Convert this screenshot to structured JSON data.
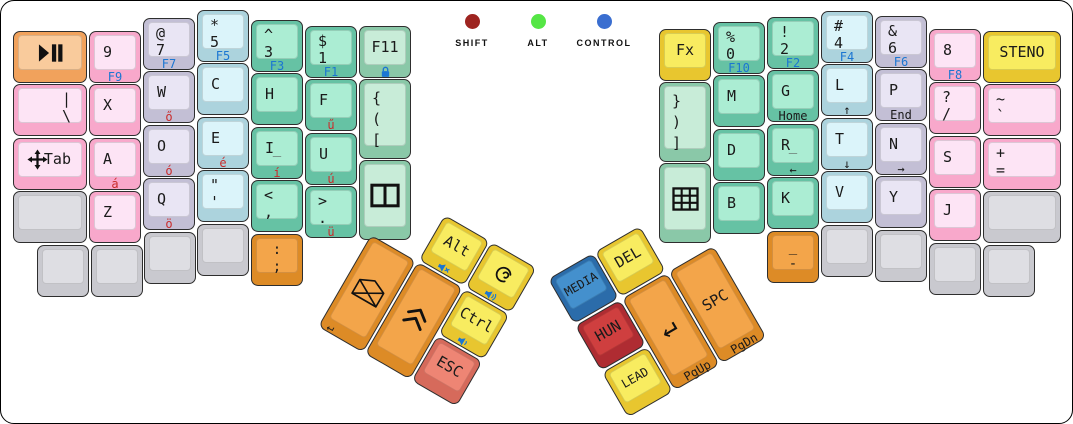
{
  "canvas": {
    "w": 1073,
    "h": 424,
    "bg": "#ffffff",
    "border": "#000000"
  },
  "palette": {
    "pink": {
      "side": "#F8A8CB",
      "top": "#FDE4F5"
    },
    "purple": {
      "side": "#C3BFD5",
      "top": "#E9E5F4"
    },
    "cyan": {
      "side": "#ACD3DD",
      "top": "#DBF4FA"
    },
    "teal": {
      "side": "#66C2A4",
      "top": "#ABEDD3"
    },
    "green": {
      "side": "#8AC8A8",
      "top": "#C8ECD8"
    },
    "yellow": {
      "side": "#E8C62F",
      "top": "#F8EC60"
    },
    "orange": {
      "side": "#DD8B26",
      "top": "#F3A54A"
    },
    "peach": {
      "side": "#F1A25C",
      "top": "#F9CB9C"
    },
    "salmon": {
      "side": "#D66A5B",
      "top": "#EE8574"
    },
    "blue": {
      "side": "#2B6CAA",
      "top": "#4490CD"
    },
    "darkred": {
      "side": "#AF2C32",
      "top": "#CF3F3F"
    },
    "gray": {
      "side": "#C9C9CF",
      "top": "#DEDEE3"
    }
  },
  "legend_colors": {
    "dark": "#1a1a1a",
    "blue": "#1B76D2",
    "red": "#C92B2B",
    "gray": "#555555"
  },
  "indicators": [
    {
      "name": "indicator-shift",
      "label": "SHIFT",
      "color": "#9E2420",
      "cx": 471,
      "top": 13
    },
    {
      "name": "indicator-alt",
      "label": "ALT",
      "color": "#55E645",
      "cx": 537,
      "top": 13
    },
    {
      "name": "indicator-control",
      "label": "CONTROL",
      "color": "#3A6ED0",
      "cx": 603,
      "top": 13
    }
  ],
  "main_keys": [
    {
      "n": "key-play-pause",
      "x": 12,
      "y": 30,
      "w": 74,
      "c": "peach",
      "ic": "play-pause"
    },
    {
      "n": "key-pipe-backslash",
      "x": 12,
      "y": 83,
      "w": 74,
      "c": "pink",
      "t": [
        "|",
        "\\"
      ],
      "a": "r"
    },
    {
      "n": "key-tab",
      "x": 12,
      "y": 137,
      "w": 74,
      "c": "pink",
      "t": [
        "Tab"
      ],
      "a": "sr",
      "ic": "move",
      "icpos": "left"
    },
    {
      "n": "key-blank",
      "x": 12,
      "y": 190,
      "w": 74,
      "c": "gray"
    },
    {
      "n": "key-9",
      "x": 88,
      "y": 30,
      "c": "pink",
      "t": [
        "9"
      ],
      "f": "F9",
      "fc": "blue"
    },
    {
      "n": "key-x",
      "x": 88,
      "y": 83,
      "c": "pink",
      "t": [
        "X"
      ]
    },
    {
      "n": "key-a",
      "x": 88,
      "y": 137,
      "c": "pink",
      "t": [
        "A"
      ],
      "f": "á",
      "fc": "red"
    },
    {
      "n": "key-z",
      "x": 88,
      "y": 190,
      "c": "pink",
      "t": [
        "Z"
      ]
    },
    {
      "n": "key-at-7",
      "x": 142,
      "y": 17,
      "c": "purple",
      "t": [
        "@",
        "7"
      ],
      "f": "F7",
      "fc": "blue"
    },
    {
      "n": "key-w",
      "x": 142,
      "y": 70,
      "c": "purple",
      "t": [
        "W"
      ],
      "f": "ő",
      "fc": "red"
    },
    {
      "n": "key-o",
      "x": 142,
      "y": 124,
      "c": "purple",
      "t": [
        "O"
      ],
      "f": "ó",
      "fc": "red"
    },
    {
      "n": "key-q",
      "x": 142,
      "y": 177,
      "c": "purple",
      "t": [
        "Q"
      ],
      "f": "ö",
      "fc": "red"
    },
    {
      "n": "key-star-5",
      "x": 196,
      "y": 9,
      "c": "cyan",
      "t": [
        "*",
        "5"
      ],
      "f": "F5",
      "fc": "blue"
    },
    {
      "n": "key-c",
      "x": 196,
      "y": 62,
      "c": "cyan",
      "t": [
        "C"
      ]
    },
    {
      "n": "key-e",
      "x": 196,
      "y": 116,
      "c": "cyan",
      "t": [
        "E"
      ],
      "f": "é",
      "fc": "red"
    },
    {
      "n": "key-quote-apostrophe",
      "x": 196,
      "y": 169,
      "c": "cyan",
      "t": [
        "\"",
        "'"
      ]
    },
    {
      "n": "key-caret-3",
      "x": 250,
      "y": 19,
      "c": "teal",
      "t": [
        "^",
        "3"
      ],
      "f": "F3",
      "fc": "blue"
    },
    {
      "n": "key-h",
      "x": 250,
      "y": 72,
      "c": "teal",
      "t": [
        "H"
      ]
    },
    {
      "n": "key-i",
      "x": 250,
      "y": 126,
      "c": "teal",
      "t": [
        "I"
      ],
      "cen": "_",
      "f": "í",
      "fc": "red"
    },
    {
      "n": "key-less-comma",
      "x": 250,
      "y": 179,
      "c": "teal",
      "t": [
        "<",
        ","
      ]
    },
    {
      "n": "key-dollar-1",
      "x": 304,
      "y": 25,
      "c": "teal",
      "t": [
        "$",
        "1"
      ],
      "f": "F1",
      "fc": "blue"
    },
    {
      "n": "key-f",
      "x": 304,
      "y": 78,
      "c": "teal",
      "t": [
        "F"
      ],
      "f": "ű",
      "fc": "red"
    },
    {
      "n": "key-u",
      "x": 304,
      "y": 132,
      "c": "teal",
      "t": [
        "U"
      ],
      "f": "ú",
      "fc": "red"
    },
    {
      "n": "key-greater-period",
      "x": 304,
      "y": 185,
      "c": "teal",
      "t": [
        ">",
        "."
      ],
      "f": "ü",
      "fc": "red"
    },
    {
      "n": "key-f11",
      "x": 358,
      "y": 25,
      "c": "green",
      "t": [
        "F11"
      ],
      "a": "c",
      "fic": "lock"
    },
    {
      "n": "key-open-brackets",
      "x": 358,
      "y": 78,
      "h": 80,
      "c": "green",
      "t": [
        "{",
        "(",
        "["
      ]
    },
    {
      "n": "key-vertical-split",
      "x": 358,
      "y": 159,
      "h": 80,
      "c": "green",
      "ic": "vsplit"
    },
    {
      "n": "key-blank",
      "x": 36,
      "y": 244,
      "c": "gray"
    },
    {
      "n": "key-blank",
      "x": 90,
      "y": 244,
      "c": "gray"
    },
    {
      "n": "key-blank",
      "x": 143,
      "y": 231,
      "c": "gray"
    },
    {
      "n": "key-blank",
      "x": 196,
      "y": 223,
      "c": "gray"
    },
    {
      "n": "key-colon-semicolon",
      "x": 250,
      "y": 233,
      "c": "orange",
      "t": [
        ":",
        ";"
      ],
      "a": "cp"
    },
    {
      "n": "key-fx",
      "x": 658,
      "y": 28,
      "c": "yellow",
      "t": [
        "Fx"
      ],
      "a": "c"
    },
    {
      "n": "key-close-brackets",
      "x": 658,
      "y": 81,
      "h": 80,
      "c": "green",
      "t": [
        "}",
        ")",
        "]"
      ]
    },
    {
      "n": "key-grid",
      "x": 658,
      "y": 162,
      "h": 80,
      "c": "green",
      "ic": "grid"
    },
    {
      "n": "key-percent-0",
      "x": 712,
      "y": 21,
      "c": "teal",
      "t": [
        "%",
        "0"
      ],
      "f": "F10",
      "fc": "blue"
    },
    {
      "n": "key-m",
      "x": 712,
      "y": 74,
      "c": "teal",
      "t": [
        "M"
      ]
    },
    {
      "n": "key-d",
      "x": 712,
      "y": 128,
      "c": "teal",
      "t": [
        "D"
      ]
    },
    {
      "n": "key-b",
      "x": 712,
      "y": 181,
      "c": "teal",
      "t": [
        "B"
      ]
    },
    {
      "n": "key-exclam-2",
      "x": 766,
      "y": 16,
      "c": "teal",
      "t": [
        "!",
        "2"
      ],
      "f": "F2",
      "fc": "blue"
    },
    {
      "n": "key-g",
      "x": 766,
      "y": 69,
      "c": "teal",
      "t": [
        "G"
      ],
      "f": "Home",
      "fc": "dark"
    },
    {
      "n": "key-r",
      "x": 766,
      "y": 123,
      "c": "teal",
      "t": [
        "R"
      ],
      "cen": "_",
      "f": "←",
      "fc": "dark"
    },
    {
      "n": "key-k",
      "x": 766,
      "y": 176,
      "c": "teal",
      "t": [
        "K"
      ]
    },
    {
      "n": "key-hash-4",
      "x": 820,
      "y": 10,
      "c": "cyan",
      "t": [
        "#",
        "4"
      ],
      "f": "F4",
      "fc": "blue"
    },
    {
      "n": "key-l",
      "x": 820,
      "y": 63,
      "c": "cyan",
      "t": [
        "L"
      ],
      "f": "↑",
      "fc": "dark"
    },
    {
      "n": "key-t",
      "x": 820,
      "y": 117,
      "c": "cyan",
      "t": [
        "T"
      ],
      "f": "↓",
      "fc": "dark"
    },
    {
      "n": "key-v",
      "x": 820,
      "y": 170,
      "c": "cyan",
      "t": [
        "V"
      ]
    },
    {
      "n": "key-amp-6",
      "x": 874,
      "y": 15,
      "c": "purple",
      "t": [
        "&",
        "6"
      ],
      "f": "F6",
      "fc": "blue"
    },
    {
      "n": "key-p",
      "x": 874,
      "y": 68,
      "c": "purple",
      "t": [
        "P"
      ],
      "f": "End",
      "fc": "dark"
    },
    {
      "n": "key-n",
      "x": 874,
      "y": 122,
      "c": "purple",
      "t": [
        "N"
      ],
      "f": "→",
      "fc": "dark"
    },
    {
      "n": "key-y",
      "x": 874,
      "y": 175,
      "c": "purple",
      "t": [
        "Y"
      ]
    },
    {
      "n": "key-8",
      "x": 928,
      "y": 28,
      "c": "pink",
      "t": [
        "8"
      ],
      "f": "F8",
      "fc": "blue"
    },
    {
      "n": "key-question-slash",
      "x": 928,
      "y": 81,
      "c": "pink",
      "t": [
        "?",
        "/"
      ]
    },
    {
      "n": "key-s",
      "x": 928,
      "y": 135,
      "c": "pink",
      "t": [
        "S"
      ]
    },
    {
      "n": "key-j",
      "x": 928,
      "y": 188,
      "c": "pink",
      "t": [
        "J"
      ]
    },
    {
      "n": "key-steno",
      "x": 982,
      "y": 30,
      "w": 78,
      "c": "yellow",
      "t": [
        "STENO"
      ],
      "a": "c"
    },
    {
      "n": "key-tilde-backtick",
      "x": 982,
      "y": 83,
      "w": 78,
      "c": "pink",
      "t": [
        "~",
        "`"
      ]
    },
    {
      "n": "key-plus-equals",
      "x": 982,
      "y": 137,
      "w": 78,
      "c": "pink",
      "t": [
        "+",
        "="
      ]
    },
    {
      "n": "key-blank",
      "x": 982,
      "y": 190,
      "w": 78,
      "c": "gray"
    },
    {
      "n": "key-underscore-hyphen",
      "x": 766,
      "y": 230,
      "c": "orange",
      "t": [
        "_",
        "-"
      ],
      "a": "cp"
    },
    {
      "n": "key-blank",
      "x": 820,
      "y": 224,
      "c": "gray"
    },
    {
      "n": "key-blank",
      "x": 874,
      "y": 229,
      "c": "gray"
    },
    {
      "n": "key-blank",
      "x": 928,
      "y": 242,
      "c": "gray"
    },
    {
      "n": "key-blank",
      "x": 982,
      "y": 244,
      "c": "gray"
    }
  ],
  "clusters": [
    {
      "name": "left-thumb-cluster",
      "x": 397,
      "y": 187,
      "angle": 30,
      "keys": [
        {
          "n": "key-alt",
          "x": 54,
          "y": 0,
          "c": "yellow",
          "t": [
            "Alt"
          ],
          "a": "c",
          "fic": "mute"
        },
        {
          "n": "key-super",
          "x": 108,
          "y": 0,
          "c": "yellow",
          "ic": "debian",
          "fic": "volup"
        },
        {
          "n": "key-mail",
          "x": 0,
          "y": 54,
          "h": 106,
          "c": "orange",
          "ic": "envelope",
          "f": "↵",
          "fc": "dark",
          "fa": "l"
        },
        {
          "n": "key-shift-up",
          "x": 54,
          "y": 54,
          "h": 106,
          "c": "orange",
          "ic": "chevrons"
        },
        {
          "n": "key-ctrl",
          "x": 108,
          "y": 54,
          "c": "yellow",
          "t": [
            "Ctrl"
          ],
          "a": "c",
          "fic": "voldown"
        },
        {
          "n": "key-esc",
          "x": 108,
          "y": 108,
          "c": "salmon",
          "t": [
            "ESC"
          ],
          "a": "c"
        }
      ]
    },
    {
      "name": "right-thumb-cluster",
      "x": 547,
      "y": 278,
      "angle": -30,
      "keys": [
        {
          "n": "key-media",
          "x": 0,
          "y": 0,
          "c": "blue",
          "t": [
            "MEDIA"
          ],
          "a": "c",
          "fs": 12
        },
        {
          "n": "key-del",
          "x": 54,
          "y": 0,
          "c": "yellow",
          "t": [
            "DEL"
          ],
          "a": "c"
        },
        {
          "n": "key-hun",
          "x": 0,
          "y": 54,
          "c": "darkred",
          "t": [
            "HUN"
          ],
          "a": "c"
        },
        {
          "n": "key-enter",
          "x": 54,
          "y": 54,
          "h": 106,
          "c": "orange",
          "ic": "enter",
          "f": "PgUp",
          "fc": "dark",
          "fa": "r"
        },
        {
          "n": "key-spc",
          "x": 108,
          "y": 54,
          "h": 106,
          "c": "orange",
          "t": [
            "SPC"
          ],
          "a": "c",
          "f": "PgDn",
          "fc": "dark",
          "fa": "r"
        },
        {
          "n": "key-lead",
          "x": 0,
          "y": 108,
          "c": "yellow",
          "t": [
            "LEAD"
          ],
          "a": "c",
          "fs": 12
        }
      ]
    }
  ]
}
